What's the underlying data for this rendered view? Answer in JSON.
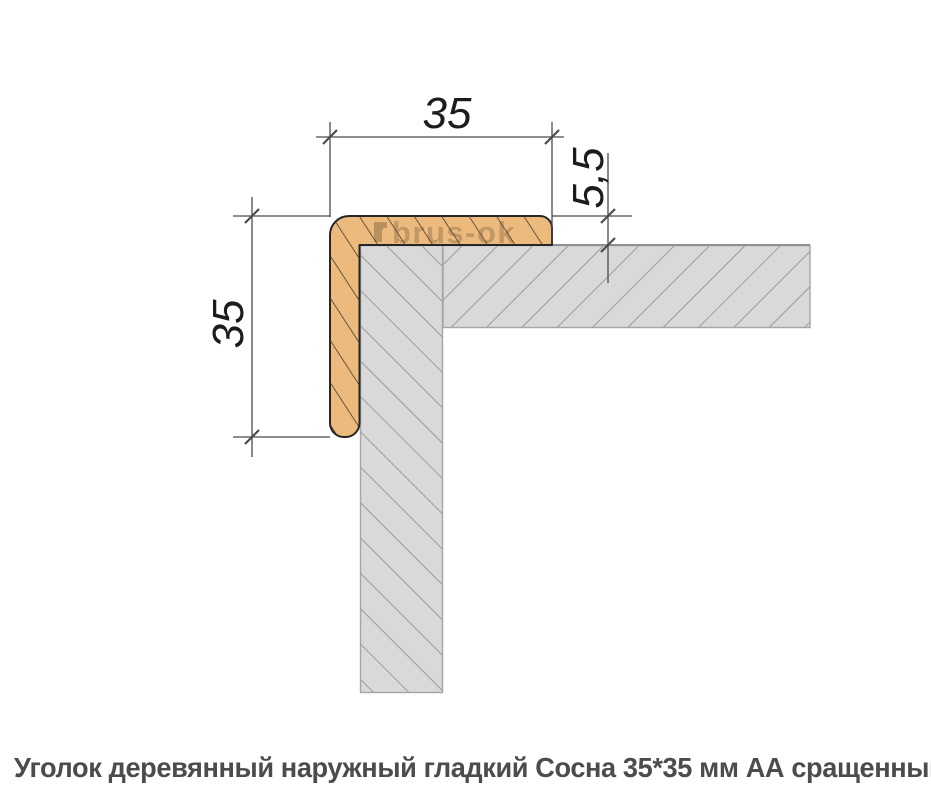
{
  "diagram": {
    "title_role": "technical cross-section of wooden outer corner trim on a wall corner",
    "dimensions": {
      "top_width": {
        "label": "35"
      },
      "left_height": {
        "label": "35"
      },
      "leg_thickness": {
        "label": "5,5"
      }
    },
    "watermark": {
      "text": "brus-ok"
    },
    "colors": {
      "wood_fill": "#ecba7d",
      "wood_outline": "#262626",
      "wall_fill": "#d9d9d9",
      "wall_edge": "#a6a6a6",
      "dim_line": "#4b4b4b",
      "dim_text": "#1c1c1c"
    }
  },
  "caption": {
    "text": "Уголок деревянный наружный гладкий Сосна 35*35 мм АА сращенный"
  }
}
